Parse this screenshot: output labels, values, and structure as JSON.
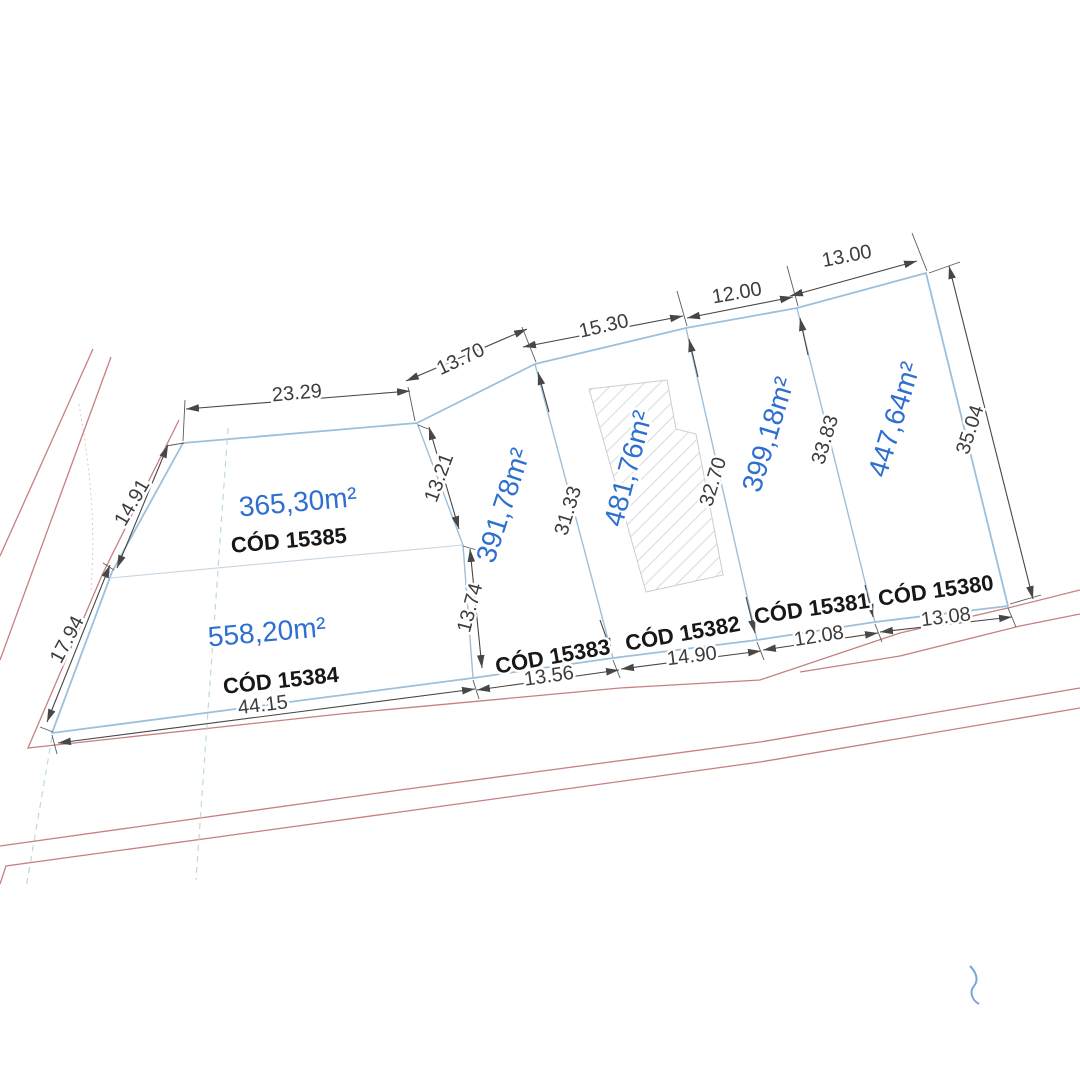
{
  "lots": [
    {
      "id": "15385",
      "code": "CÓD 15385",
      "area": "365,30m²"
    },
    {
      "id": "15384",
      "code": "CÓD 15384",
      "area": "558,20m²"
    },
    {
      "id": "15383",
      "code": "CÓD 15383",
      "area": "391,78m²"
    },
    {
      "id": "15382",
      "code": "CÓD 15382",
      "area": "481,76m²"
    },
    {
      "id": "15381",
      "code": "CÓD 15381",
      "area": "399,18m²"
    },
    {
      "id": "15380",
      "code": "CÓD 15380",
      "area": "447,64m²"
    }
  ],
  "dimensions": {
    "top_edge": [
      "23.29",
      "13.70",
      "15.30",
      "12.00",
      "13.00"
    ],
    "right_edge": [
      "35.04"
    ],
    "left_edge": [
      "14.91",
      "17.94"
    ],
    "bottom_edge": [
      "44.15",
      "13.56",
      "14.90",
      "12.08",
      "13.08"
    ],
    "internal": [
      "13.21",
      "13.74",
      "31.33",
      "32.70",
      "33.83"
    ]
  },
  "colors": {
    "lot_boundary": "#9cc0dc",
    "road_line": "#c4787a",
    "area_label": "#2e6fd0",
    "code_label": "#171717",
    "dimension_label": "#3c3c3c",
    "building_hatch": "#d9dde1"
  }
}
